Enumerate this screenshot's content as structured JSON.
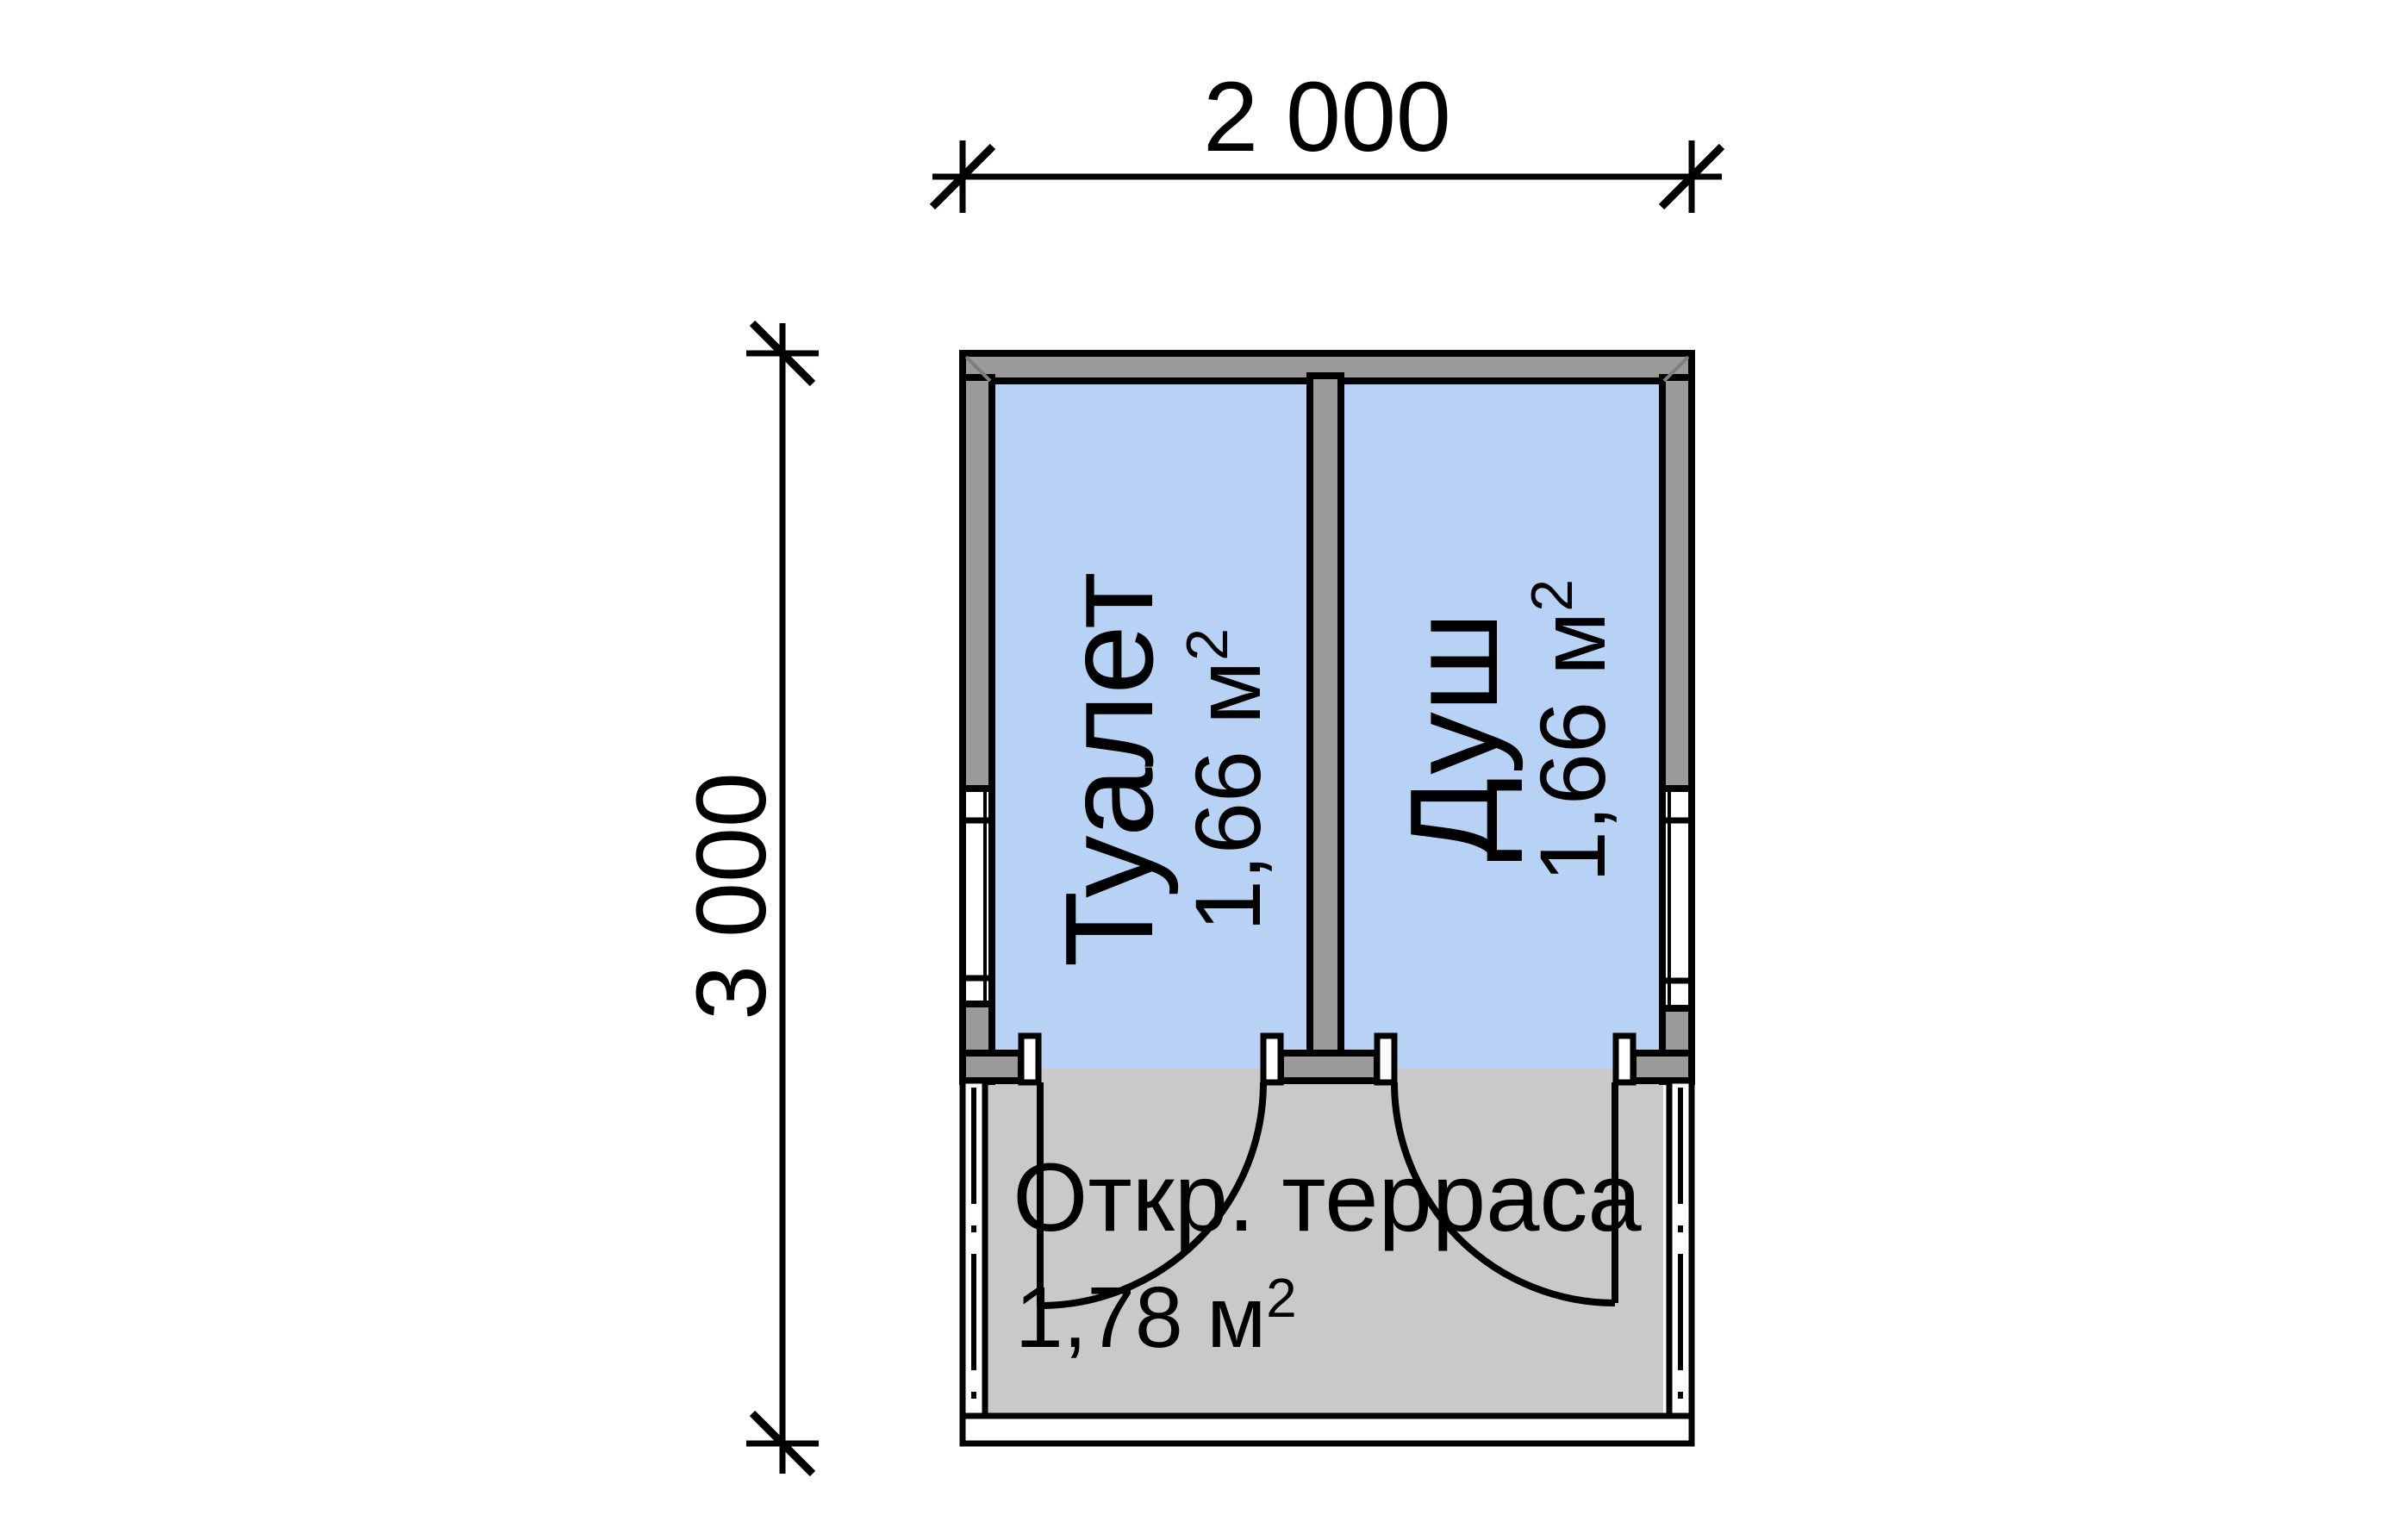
{
  "dimensions": {
    "width_mm": "2 000",
    "height_mm": "3 000"
  },
  "rooms": [
    {
      "name": "Туалет",
      "area": "1,66 м",
      "area_sup": "2"
    },
    {
      "name": "Душ",
      "area": "1,66 м",
      "area_sup": "2"
    }
  ],
  "terrace": {
    "name": "Откр. терраса",
    "area": "1,78 м",
    "area_sup": "2"
  },
  "colors": {
    "wall": "#9a9a9a",
    "room_fill": "#b7d2f4",
    "terrace_fill": "#c9c9c9",
    "window_fill": "#ffffff",
    "line": "#000000",
    "background": "#ffffff"
  }
}
